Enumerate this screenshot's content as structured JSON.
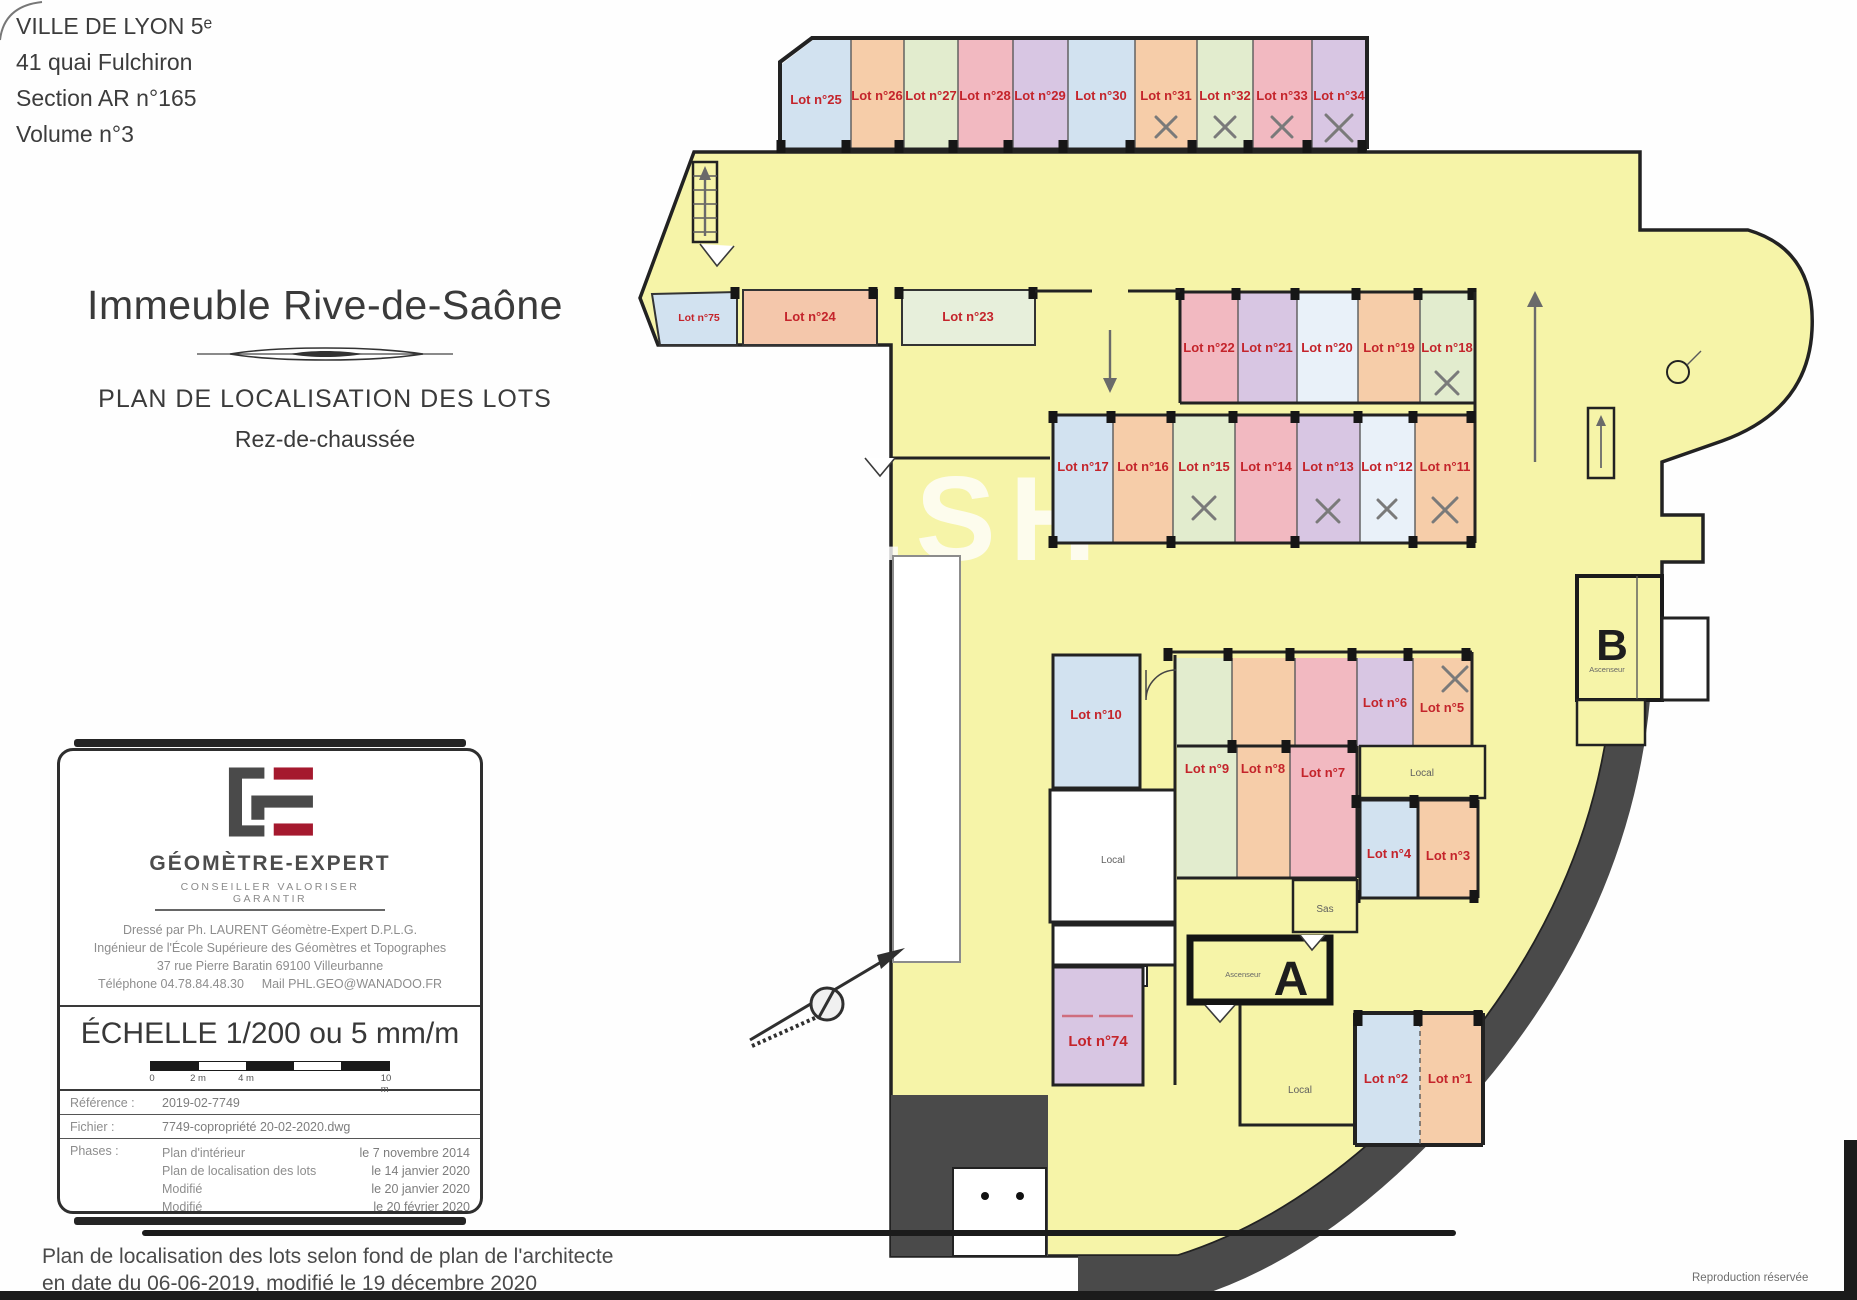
{
  "header": {
    "line1": "VILLE DE LYON 5ᵉ",
    "line2": "41 quai Fulchiron",
    "line3": "Section AR n°165",
    "line4": "Volume n°3"
  },
  "title": {
    "building": "Immeuble Rive-de-Saône",
    "plan": "PLAN DE LOCALISATION DES LOTS",
    "level": "Rez-de-chaussée"
  },
  "plan": {
    "watermark": "MALSH",
    "lots": [
      {
        "label": "Lot n°25"
      },
      {
        "label": "Lot n°26"
      },
      {
        "label": "Lot n°27"
      },
      {
        "label": "Lot n°28"
      },
      {
        "label": "Lot n°29"
      },
      {
        "label": "Lot n°30"
      },
      {
        "label": "Lot n°31",
        "crossed": true
      },
      {
        "label": "Lot n°32",
        "crossed": true
      },
      {
        "label": "Lot n°33",
        "crossed": true
      },
      {
        "label": "Lot n°34",
        "crossed": true
      },
      {
        "label": "Lot n°75"
      },
      {
        "label": "Lot n°24"
      },
      {
        "label": "Lot n°23"
      },
      {
        "label": "Lot n°22"
      },
      {
        "label": "Lot n°21"
      },
      {
        "label": "Lot n°20"
      },
      {
        "label": "Lot n°19"
      },
      {
        "label": "Lot n°18",
        "crossed": true
      },
      {
        "label": "Lot n°17"
      },
      {
        "label": "Lot n°16"
      },
      {
        "label": "Lot n°15",
        "crossed": true
      },
      {
        "label": "Lot n°14"
      },
      {
        "label": "Lot n°13",
        "crossed": true
      },
      {
        "label": "Lot n°12",
        "crossed": true
      },
      {
        "label": "Lot n°11",
        "crossed": true
      },
      {
        "label": "Lot n°10"
      },
      {
        "label": "Lot n°6"
      },
      {
        "label": "Lot n°5",
        "crossed": true
      },
      {
        "label": "Lot n°9"
      },
      {
        "label": "Lot n°8"
      },
      {
        "label": "Lot n°7"
      },
      {
        "label": "Lot n°4"
      },
      {
        "label": "Lot n°3"
      },
      {
        "label": "Lot n°74"
      },
      {
        "label": "Lot n°2"
      },
      {
        "label": "Lot n°1"
      }
    ],
    "rooms": {
      "local": "Local",
      "sas": "Sas",
      "ascenseur": "Ascenseur",
      "entrance_a": "A",
      "entrance_b": "B"
    }
  },
  "cartouche": {
    "logo_title": "GÉOMÈTRE-EXPERT",
    "logo_tagline": "CONSEILLER VALORISER GARANTIR",
    "line1": "Dressé par Ph. LAURENT Géomètre-Expert D.P.L.G.",
    "line2": "Ingénieur de l'École Supérieure des Géomètres et Topographes",
    "line3": "37 rue Pierre Baratin 69100 Villeurbanne",
    "phone": "Téléphone 04.78.84.48.30",
    "mail": "Mail PHL.GEO@WANADOO.FR",
    "scale_title": "ÉCHELLE 1/200 ou 5 mm/m",
    "scale_ticks": [
      "0",
      "2 m",
      "4 m",
      "10 m"
    ],
    "reference_label": "Référence :",
    "reference_value": "2019-02-7749",
    "file_label": "Fichier :",
    "file_value": "7749-copropriété 20-02-2020.dwg",
    "phases_label": "Phases :",
    "phases": [
      {
        "name": "Plan d'intérieur",
        "date": "le 7 novembre 2014"
      },
      {
        "name": "Plan de localisation des lots",
        "date": "le 14 janvier 2020"
      },
      {
        "name": "Modifié",
        "date": "le 20 janvier 2020"
      },
      {
        "name": "Modifié",
        "date": "le 20 février 2020"
      }
    ]
  },
  "footer": {
    "caption_line1": "Plan de localisation des lots selon fond de plan de l'architecte",
    "caption_line2": "en date du 06-06-2019, modifié le 19 décembre 2020",
    "rights": "Reproduction réservée"
  }
}
